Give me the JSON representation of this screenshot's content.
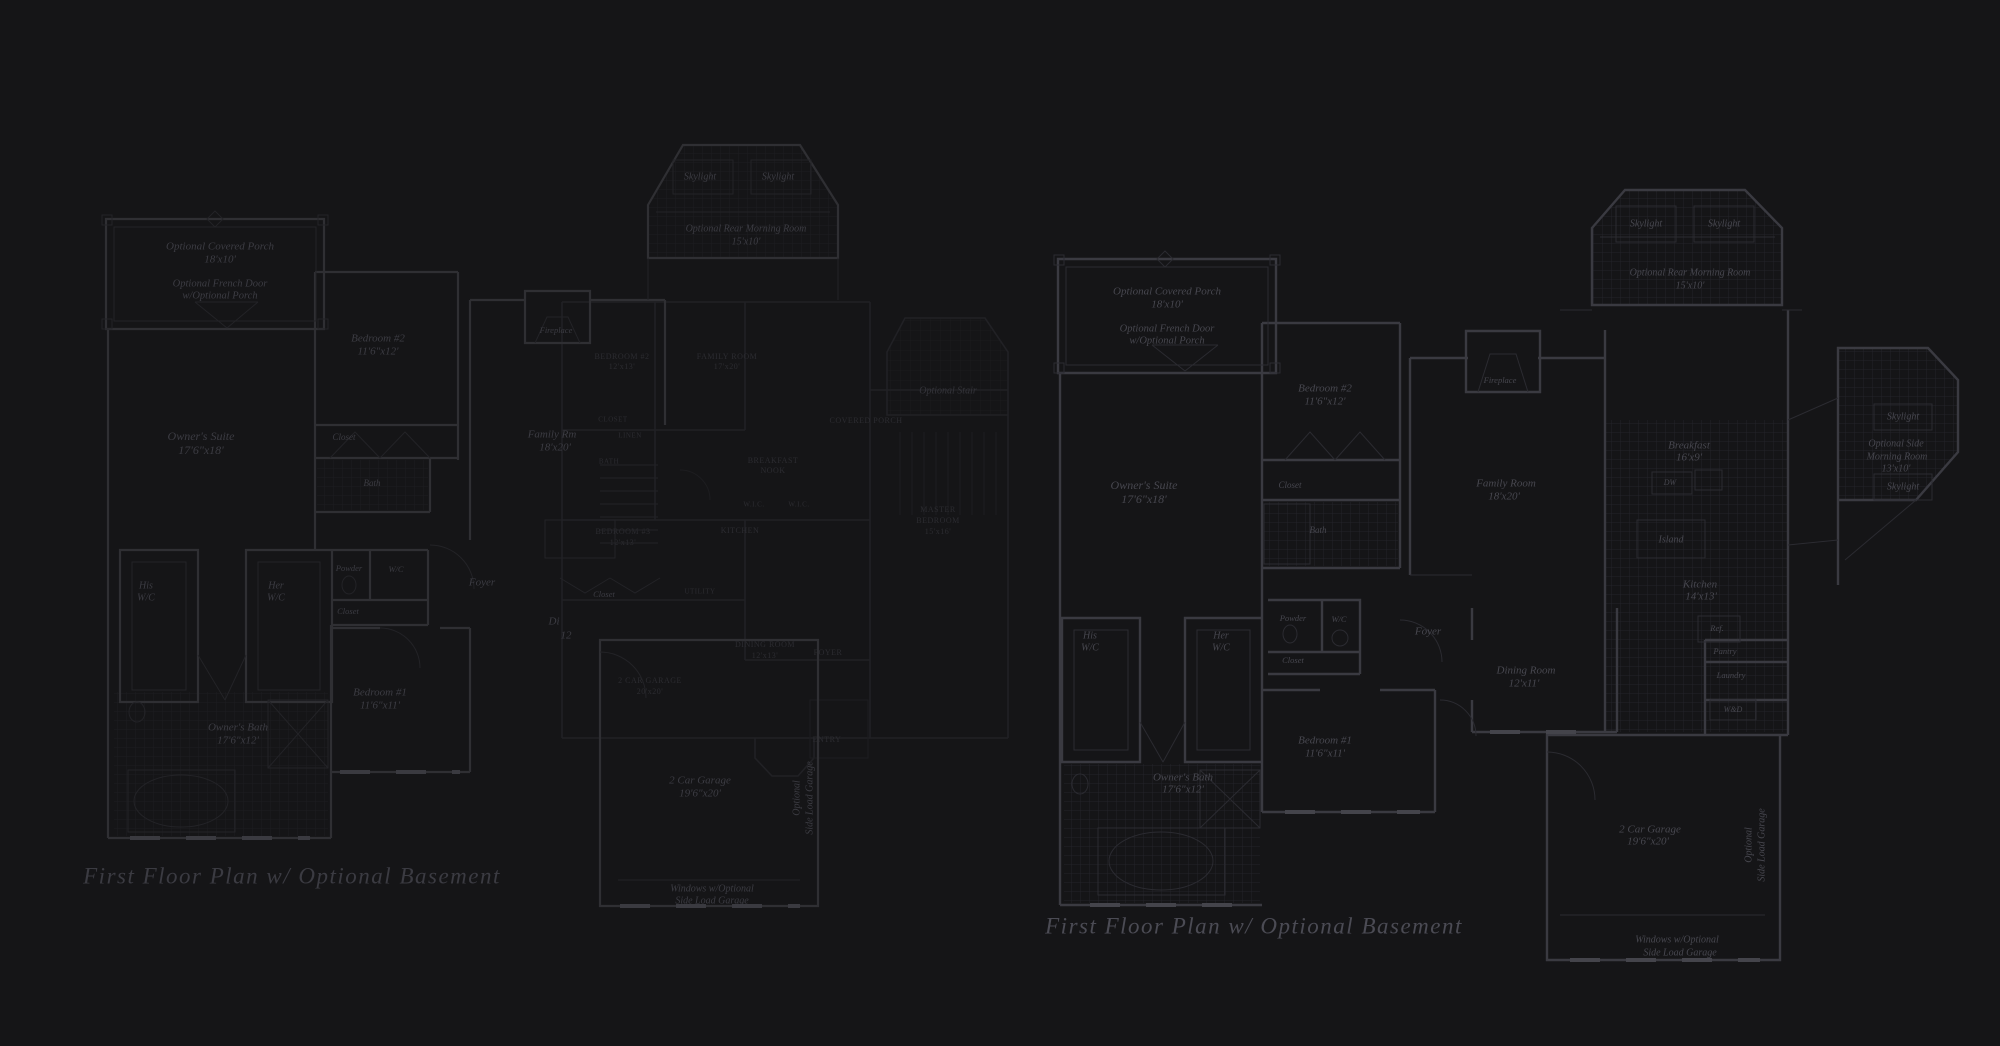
{
  "canvas": {
    "width": 2000,
    "height": 1046,
    "background": "#151517"
  },
  "colors": {
    "background": "#151517",
    "left_plan_lines": "#2f2f33",
    "middle_plan_lines": "#212125",
    "right_plan_lines": "#3a3a41",
    "left_text": "#3c3c43",
    "middle_text": "#2c2c31",
    "right_text": "#47474f",
    "title_left": "#3b3b42",
    "title_right": "#4b4b54"
  },
  "titles": {
    "left": "First Floor Plan w/ Optional Basement",
    "right": "First Floor Plan w/ Optional Basement"
  },
  "plans": {
    "left": {
      "labels": [
        {
          "t": "Skylight",
          "x": 700,
          "y": 177,
          "s": 10,
          "n": "label-skylight"
        },
        {
          "t": "Skylight",
          "x": 778,
          "y": 177,
          "s": 10,
          "n": "label-skylight"
        },
        {
          "t": "Optional Rear Morning Room",
          "x": 746,
          "y": 229,
          "s": 10,
          "n": "label-morning-room"
        },
        {
          "t": "15'x10'",
          "x": 746,
          "y": 242,
          "s": 10,
          "n": "label-morning-room-dims"
        },
        {
          "t": "Optional Covered Porch",
          "x": 220,
          "y": 247,
          "s": 11,
          "n": "label-covered-porch"
        },
        {
          "t": "18'x10'",
          "x": 220,
          "y": 260,
          "s": 11,
          "n": "label-covered-porch-dims"
        },
        {
          "t": "Optional French Door",
          "x": 220,
          "y": 284,
          "s": 10.5,
          "n": "label-french-door"
        },
        {
          "t": "w/Optional Porch",
          "x": 220,
          "y": 296,
          "s": 10.5,
          "n": "label-french-door"
        },
        {
          "t": "Bedroom #2",
          "x": 378,
          "y": 339,
          "s": 11,
          "n": "label-bedroom-2"
        },
        {
          "t": "11'6\"x12'",
          "x": 378,
          "y": 352,
          "s": 11,
          "n": "label-bedroom-2-dims"
        },
        {
          "t": "Owner's Suite",
          "x": 201,
          "y": 437,
          "s": 12,
          "n": "label-owners-suite"
        },
        {
          "t": "17'6\"x18'",
          "x": 201,
          "y": 451,
          "s": 12,
          "n": "label-owners-suite-dims"
        },
        {
          "t": "Closet",
          "x": 344,
          "y": 438,
          "s": 9,
          "n": "label-closet"
        },
        {
          "t": "Bath",
          "x": 372,
          "y": 484,
          "s": 9,
          "n": "label-bath"
        },
        {
          "t": "His",
          "x": 146,
          "y": 586,
          "s": 10,
          "n": "label-his-wic"
        },
        {
          "t": "W/C",
          "x": 146,
          "y": 598,
          "s": 10,
          "n": "label-his-wic"
        },
        {
          "t": "Her",
          "x": 276,
          "y": 586,
          "s": 10,
          "n": "label-her-wic"
        },
        {
          "t": "W/C",
          "x": 276,
          "y": 598,
          "s": 10,
          "n": "label-her-wic"
        },
        {
          "t": "Powder",
          "x": 349,
          "y": 569,
          "s": 8.5,
          "n": "label-powder"
        },
        {
          "t": "W/C",
          "x": 396,
          "y": 570,
          "s": 8.5,
          "n": "label-wc"
        },
        {
          "t": "Closet",
          "x": 348,
          "y": 612,
          "s": 8.5,
          "n": "label-closet"
        },
        {
          "t": "Foyer",
          "x": 482,
          "y": 583,
          "s": 11,
          "n": "label-foyer"
        },
        {
          "t": "Closet",
          "x": 604,
          "y": 595,
          "s": 8.5,
          "n": "label-closet"
        },
        {
          "t": "Bedroom #1",
          "x": 380,
          "y": 693,
          "s": 11,
          "n": "label-bedroom-1"
        },
        {
          "t": "11'6\"x11'",
          "x": 380,
          "y": 706,
          "s": 11,
          "n": "label-bedroom-1-dims"
        },
        {
          "t": "Owner's Bath",
          "x": 238,
          "y": 728,
          "s": 11,
          "n": "label-owners-bath"
        },
        {
          "t": "17'6\"x12'",
          "x": 238,
          "y": 741,
          "s": 11,
          "n": "label-owners-bath-dims"
        },
        {
          "t": "Family Rm",
          "x": 552,
          "y": 435,
          "s": 11,
          "n": "label-family-room"
        },
        {
          "t": "18'x20'",
          "x": 555,
          "y": 448,
          "s": 11,
          "n": "label-family-room-dims"
        },
        {
          "t": "Fireplace",
          "x": 556,
          "y": 331,
          "s": 8.5,
          "n": "label-fireplace"
        },
        {
          "t": "Di",
          "x": 554,
          "y": 622,
          "s": 11,
          "n": "label-dining-partial"
        },
        {
          "t": "12",
          "x": 566,
          "y": 636,
          "s": 11,
          "n": "label-dining-dims-partial"
        },
        {
          "t": "2 Car Garage",
          "x": 700,
          "y": 781,
          "s": 11,
          "n": "label-garage"
        },
        {
          "t": "19'6\"x20'",
          "x": 700,
          "y": 794,
          "s": 11,
          "n": "label-garage-dims"
        },
        {
          "t": "Windows w/Optional",
          "x": 712,
          "y": 889,
          "s": 10,
          "n": "label-garage-windows"
        },
        {
          "t": "Side Load Garage",
          "x": 712,
          "y": 901,
          "s": 10,
          "n": "label-garage-windows"
        },
        {
          "t": "Optional",
          "x": 797,
          "y": 798,
          "s": 10,
          "r": -90,
          "n": "label-side-load-garage-vertical"
        },
        {
          "t": "Side Load Garage",
          "x": 810,
          "y": 798,
          "s": 10,
          "r": -90,
          "n": "label-side-load-garage-vertical"
        }
      ]
    },
    "middle": {
      "labels": [
        {
          "t": "BEDROOM #2",
          "x": 622,
          "y": 357,
          "s": 8,
          "c": 1,
          "n": "label-bedroom-2"
        },
        {
          "t": "12'x13'",
          "x": 622,
          "y": 367,
          "s": 8,
          "c": 1,
          "n": "label-bedroom-2-dims"
        },
        {
          "t": "FAMILY ROOM",
          "x": 727,
          "y": 357,
          "s": 8,
          "c": 1,
          "n": "label-family-room"
        },
        {
          "t": "17'x20'",
          "x": 727,
          "y": 367,
          "s": 8,
          "c": 1,
          "n": "label-family-room-dims"
        },
        {
          "t": "CLOSET",
          "x": 613,
          "y": 420,
          "s": 7,
          "c": 1,
          "n": "label-closet"
        },
        {
          "t": "LINEN",
          "x": 630,
          "y": 436,
          "s": 7,
          "c": 1,
          "n": "label-linen"
        },
        {
          "t": "BATH",
          "x": 609,
          "y": 462,
          "s": 7,
          "c": 1,
          "n": "label-bath"
        },
        {
          "t": "BREAKFAST",
          "x": 773,
          "y": 461,
          "s": 8,
          "c": 1,
          "n": "label-breakfast-nook"
        },
        {
          "t": "NOOK",
          "x": 773,
          "y": 471,
          "s": 8,
          "c": 1,
          "n": "label-breakfast-nook"
        },
        {
          "t": "COVERED PORCH",
          "x": 866,
          "y": 421,
          "s": 8,
          "c": 1,
          "n": "label-covered-porch"
        },
        {
          "t": "W.I.C.",
          "x": 754,
          "y": 505,
          "s": 7,
          "c": 1,
          "n": "label-wic"
        },
        {
          "t": "W.I.C.",
          "x": 799,
          "y": 505,
          "s": 7,
          "c": 1,
          "n": "label-wic"
        },
        {
          "t": "BEDROOM #3",
          "x": 623,
          "y": 532,
          "s": 8,
          "c": 1,
          "n": "label-bedroom-3"
        },
        {
          "t": "12'x13'",
          "x": 623,
          "y": 543,
          "s": 8,
          "c": 1,
          "n": "label-bedroom-3-dims"
        },
        {
          "t": "KITCHEN",
          "x": 740,
          "y": 531,
          "s": 8,
          "c": 1,
          "n": "label-kitchen"
        },
        {
          "t": "UTILITY",
          "x": 700,
          "y": 592,
          "s": 7,
          "c": 1,
          "n": "label-utility"
        },
        {
          "t": "DINING ROOM",
          "x": 765,
          "y": 645,
          "s": 8,
          "c": 1,
          "n": "label-dining-room"
        },
        {
          "t": "12'x13'",
          "x": 765,
          "y": 656,
          "s": 8,
          "c": 1,
          "n": "label-dining-room-dims"
        },
        {
          "t": "FOYER",
          "x": 828,
          "y": 653,
          "s": 8,
          "c": 1,
          "n": "label-foyer"
        },
        {
          "t": "2 CAR GARAGE",
          "x": 650,
          "y": 681,
          "s": 8,
          "c": 1,
          "n": "label-garage"
        },
        {
          "t": "20'x20'",
          "x": 650,
          "y": 692,
          "s": 8,
          "c": 1,
          "n": "label-garage-dims"
        },
        {
          "t": "ENTRY",
          "x": 827,
          "y": 740,
          "s": 8,
          "c": 1,
          "n": "label-entry"
        },
        {
          "t": "MASTER",
          "x": 938,
          "y": 510,
          "s": 8,
          "c": 1,
          "n": "label-master-bedroom"
        },
        {
          "t": "BEDROOM",
          "x": 938,
          "y": 521,
          "s": 8,
          "c": 1,
          "n": "label-master-bedroom"
        },
        {
          "t": "15'x16'",
          "x": 938,
          "y": 532,
          "s": 8,
          "c": 1,
          "n": "label-master-bedroom-dims"
        },
        {
          "t": "Optional Stair",
          "x": 948,
          "y": 391,
          "s": 10,
          "it": 1,
          "n": "label-optional-stair"
        }
      ]
    },
    "right": {
      "labels": [
        {
          "t": "Skylight",
          "x": 1646,
          "y": 224,
          "s": 10,
          "n": "label-skylight"
        },
        {
          "t": "Skylight",
          "x": 1724,
          "y": 224,
          "s": 10,
          "n": "label-skylight"
        },
        {
          "t": "Optional Rear Morning Room",
          "x": 1690,
          "y": 273,
          "s": 10,
          "n": "label-morning-room"
        },
        {
          "t": "15'x10'",
          "x": 1690,
          "y": 286,
          "s": 10,
          "n": "label-morning-room-dims"
        },
        {
          "t": "Optional Covered Porch",
          "x": 1167,
          "y": 292,
          "s": 11,
          "n": "label-covered-porch"
        },
        {
          "t": "18'x10'",
          "x": 1167,
          "y": 305,
          "s": 11,
          "n": "label-covered-porch-dims"
        },
        {
          "t": "Optional French Door",
          "x": 1167,
          "y": 329,
          "s": 10.5,
          "n": "label-french-door"
        },
        {
          "t": "w/Optional Porch",
          "x": 1167,
          "y": 341,
          "s": 10.5,
          "n": "label-french-door"
        },
        {
          "t": "Bedroom #2",
          "x": 1325,
          "y": 389,
          "s": 11,
          "n": "label-bedroom-2"
        },
        {
          "t": "11'6\"x12'",
          "x": 1325,
          "y": 402,
          "s": 11,
          "n": "label-bedroom-2-dims"
        },
        {
          "t": "Owner's Suite",
          "x": 1144,
          "y": 486,
          "s": 12,
          "n": "label-owners-suite"
        },
        {
          "t": "17'6\"x18'",
          "x": 1144,
          "y": 500,
          "s": 12,
          "n": "label-owners-suite-dims"
        },
        {
          "t": "Closet",
          "x": 1290,
          "y": 486,
          "s": 9,
          "n": "label-closet"
        },
        {
          "t": "Bath",
          "x": 1318,
          "y": 531,
          "s": 9,
          "n": "label-bath"
        },
        {
          "t": "Fireplace",
          "x": 1500,
          "y": 381,
          "s": 8.5,
          "n": "label-fireplace"
        },
        {
          "t": "Family Room",
          "x": 1506,
          "y": 484,
          "s": 11,
          "n": "label-family-room"
        },
        {
          "t": "18'x20'",
          "x": 1504,
          "y": 497,
          "s": 11,
          "n": "label-family-room-dims"
        },
        {
          "t": "Breakfast",
          "x": 1689,
          "y": 446,
          "s": 11,
          "n": "label-breakfast"
        },
        {
          "t": "16'x9'",
          "x": 1689,
          "y": 458,
          "s": 11,
          "n": "label-breakfast-dims"
        },
        {
          "t": "DW",
          "x": 1670,
          "y": 483,
          "s": 8,
          "n": "label-dishwasher"
        },
        {
          "t": "Island",
          "x": 1671,
          "y": 540,
          "s": 10,
          "n": "label-island"
        },
        {
          "t": "Kitchen",
          "x": 1700,
          "y": 585,
          "s": 11,
          "n": "label-kitchen"
        },
        {
          "t": "14'x13'",
          "x": 1701,
          "y": 597,
          "s": 11,
          "n": "label-kitchen-dims"
        },
        {
          "t": "Ref.",
          "x": 1717,
          "y": 629,
          "s": 8.5,
          "n": "label-refrigerator"
        },
        {
          "t": "Pantry",
          "x": 1725,
          "y": 652,
          "s": 8.5,
          "n": "label-pantry"
        },
        {
          "t": "Laundry",
          "x": 1731,
          "y": 676,
          "s": 8.5,
          "n": "label-laundry"
        },
        {
          "t": "W&D",
          "x": 1733,
          "y": 710,
          "s": 8,
          "n": "label-washer-dryer"
        },
        {
          "t": "Skylight",
          "x": 1903,
          "y": 417,
          "s": 10,
          "n": "label-skylight"
        },
        {
          "t": "Optional Side",
          "x": 1896,
          "y": 444,
          "s": 10,
          "n": "label-side-morning-room"
        },
        {
          "t": "Morning Room",
          "x": 1897,
          "y": 457,
          "s": 10,
          "n": "label-side-morning-room"
        },
        {
          "t": "13'x10'",
          "x": 1896,
          "y": 469,
          "s": 10,
          "n": "label-side-morning-room-dims"
        },
        {
          "t": "Skylight",
          "x": 1903,
          "y": 487,
          "s": 10,
          "n": "label-skylight"
        },
        {
          "t": "Powder",
          "x": 1293,
          "y": 619,
          "s": 8.5,
          "n": "label-powder"
        },
        {
          "t": "W/C",
          "x": 1339,
          "y": 620,
          "s": 8.5,
          "n": "label-wc"
        },
        {
          "t": "Foyer",
          "x": 1428,
          "y": 632,
          "s": 11,
          "n": "label-foyer"
        },
        {
          "t": "Closet",
          "x": 1293,
          "y": 661,
          "s": 8.5,
          "n": "label-closet"
        },
        {
          "t": "His",
          "x": 1090,
          "y": 636,
          "s": 10,
          "n": "label-his-wic"
        },
        {
          "t": "W/C",
          "x": 1090,
          "y": 648,
          "s": 10,
          "n": "label-his-wic"
        },
        {
          "t": "Her",
          "x": 1221,
          "y": 636,
          "s": 10,
          "n": "label-her-wic"
        },
        {
          "t": "W/C",
          "x": 1221,
          "y": 648,
          "s": 10,
          "n": "label-her-wic"
        },
        {
          "t": "Bedroom #1",
          "x": 1325,
          "y": 741,
          "s": 11,
          "n": "label-bedroom-1"
        },
        {
          "t": "11'6\"x11'",
          "x": 1325,
          "y": 754,
          "s": 11,
          "n": "label-bedroom-1-dims"
        },
        {
          "t": "Owner's Bath",
          "x": 1183,
          "y": 778,
          "s": 11,
          "n": "label-owners-bath"
        },
        {
          "t": "17'6\"x12'",
          "x": 1183,
          "y": 790,
          "s": 11,
          "n": "label-owners-bath-dims"
        },
        {
          "t": "Dining Room",
          "x": 1526,
          "y": 671,
          "s": 11,
          "n": "label-dining-room"
        },
        {
          "t": "12'x11'",
          "x": 1524,
          "y": 684,
          "s": 11,
          "n": "label-dining-room-dims"
        },
        {
          "t": "2 Car Garage",
          "x": 1650,
          "y": 830,
          "s": 11,
          "n": "label-garage"
        },
        {
          "t": "19'6\"x20'",
          "x": 1648,
          "y": 842,
          "s": 11,
          "n": "label-garage-dims"
        },
        {
          "t": "Optional",
          "x": 1749,
          "y": 845,
          "s": 10,
          "r": -90,
          "n": "label-side-load-garage-vertical"
        },
        {
          "t": "Side Load Garage",
          "x": 1762,
          "y": 845,
          "s": 10,
          "r": -90,
          "n": "label-side-load-garage-vertical"
        },
        {
          "t": "Windows w/Optional",
          "x": 1677,
          "y": 940,
          "s": 10,
          "n": "label-garage-windows"
        },
        {
          "t": "Side Load Garage",
          "x": 1680,
          "y": 953,
          "s": 10,
          "n": "label-garage-windows"
        }
      ]
    }
  }
}
